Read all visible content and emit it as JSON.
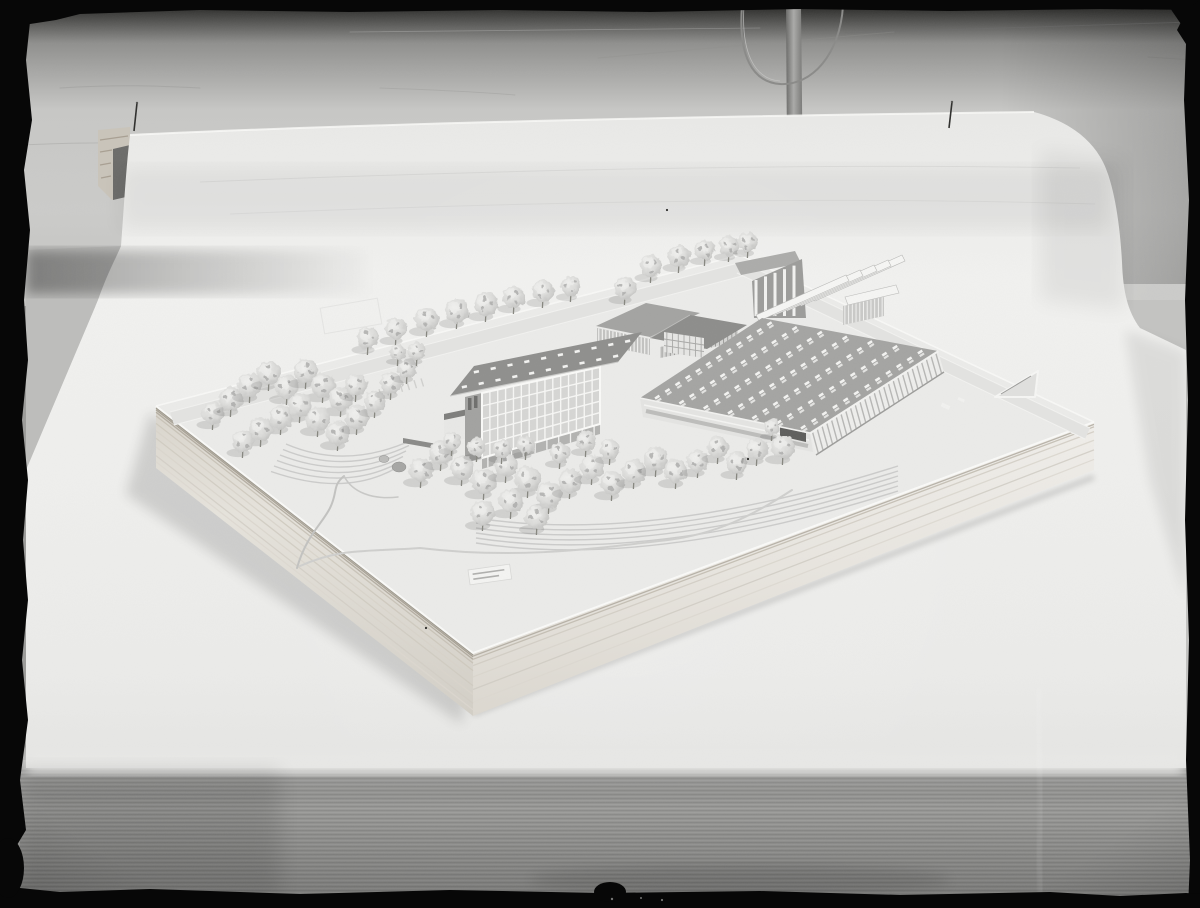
{
  "photo": {
    "kind": "black-and-white photograph",
    "subject": "architectural scale model of a school campus on a wooden baseboard, placed on a cloth-covered table in front of white backdrop paper pinned to a wall",
    "colors": {
      "film_border": "#070707",
      "wall": "#c7c7c5",
      "paper": "#efefed",
      "cloth": "#959593",
      "wood_light": "#e9e6e0",
      "wood_dark": "#9a9487",
      "roof_dark": "#8f8f8d",
      "roof_mid": "#a6a6a4",
      "foliage": "#d7d7d5",
      "skylight": "#f3f3f1",
      "shadow": "#4a4a48"
    },
    "pins": [
      {
        "x1": 137,
        "y1": 103,
        "x2": 134,
        "y2": 131
      },
      {
        "x1": 952,
        "y1": 102,
        "x2": 949,
        "y2": 128
      }
    ],
    "dust_specks": [
      [
        667,
        210
      ],
      [
        748,
        459
      ],
      [
        426,
        628
      ]
    ]
  },
  "model": {
    "base_top": [
      [
        156,
        406
      ],
      [
        740,
        255
      ],
      [
        1094,
        422
      ],
      [
        473,
        653
      ]
    ],
    "base_front_left": [
      [
        156,
        406
      ],
      [
        473,
        653
      ],
      [
        473,
        716
      ],
      [
        156,
        468
      ]
    ],
    "base_front_right": [
      [
        473,
        653
      ],
      [
        1094,
        422
      ],
      [
        1094,
        470
      ],
      [
        473,
        716
      ]
    ],
    "wood_grain_left": {
      "offsets": [
        0.03,
        0.06,
        0.1,
        0.16,
        0.28,
        0.4,
        0.52,
        0.66,
        0.8,
        0.9
      ],
      "colors": [
        "#8e897d",
        "#9b9487",
        "#aaa396",
        "#c4beb2",
        "#cdc7bb",
        "#d8d3c9",
        "#cfcabf",
        "#dad5cc",
        "#d2cdc4",
        "#ddd8d0"
      ]
    },
    "wood_grain_right": {
      "offsets": [
        0.05,
        0.1,
        0.2,
        0.38,
        0.58,
        0.78
      ],
      "colors": [
        "#aca69a",
        "#bdb7ab",
        "#d0cbc1",
        "#d9d5cc",
        "#cfcbc2",
        "#dcd8d0"
      ]
    },
    "plaque": {
      "x": 468,
      "y": 570,
      "w": 42,
      "h": 15,
      "rotation": -8,
      "text_lines": 2
    },
    "roads": {
      "back_left": [
        [
          170,
          412
        ],
        [
          742,
          262
        ],
        [
          746,
          275
        ],
        [
          174,
          425
        ]
      ],
      "back_right": [
        [
          742,
          262
        ],
        [
          1090,
          428
        ],
        [
          1085,
          439
        ],
        [
          737,
          273
        ]
      ]
    },
    "parking": {
      "start": [
        372,
        391
      ],
      "step": [
        7,
        -1.8
      ],
      "count": 8,
      "dash": [
        2.5,
        8
      ]
    },
    "terraces": [
      {
        "start": [
          286,
          444
        ],
        "ctrl": [
          346,
          470
        ],
        "end": [
          412,
          440
        ],
        "count": 6,
        "dx": -3,
        "dy": 5.5
      },
      {
        "start": [
          476,
          518
        ],
        "ctrl": [
          650,
          545
        ],
        "end": [
          898,
          466
        ],
        "count": 6,
        "dx": 0,
        "dy": 5
      }
    ],
    "ponds": [
      {
        "cx": 384,
        "cy": 459,
        "rx": 5,
        "ry": 3.5
      },
      {
        "cx": 399,
        "cy": 467,
        "rx": 7,
        "ry": 5
      }
    ],
    "vehicle": {
      "x": 438,
      "y": 445,
      "w": 10,
      "h": 6,
      "rotation": -12
    },
    "hedge": [
      [
        403,
        438
      ],
      [
        437,
        444
      ],
      [
        437,
        449
      ],
      [
        403,
        443
      ]
    ],
    "buildings": {
      "slab": {
        "name": "four-storey classroom slab with grid curtain wall",
        "roof": [
          [
            450,
            396
          ],
          [
            618,
            362
          ],
          [
            642,
            332
          ],
          [
            474,
            366
          ]
        ],
        "skylight_rows": 2,
        "skylight_cols": 10,
        "facade": [
          [
            482,
            393
          ],
          [
            600,
            367
          ],
          [
            600,
            424
          ],
          [
            482,
            458
          ]
        ],
        "grid_cols": 15,
        "grid_rows": 5,
        "end_wall": [
          [
            465,
            397
          ],
          [
            482,
            393
          ],
          [
            482,
            458
          ],
          [
            465,
            463
          ]
        ],
        "ground_floor": [
          [
            482,
            458
          ],
          [
            600,
            424
          ],
          [
            600,
            434
          ],
          [
            482,
            469
          ]
        ],
        "wing_roof": [
          [
            444,
            414
          ],
          [
            468,
            409
          ],
          [
            468,
            415
          ],
          [
            444,
            420
          ]
        ],
        "wing_wall": [
          [
            444,
            420
          ],
          [
            468,
            415
          ],
          [
            468,
            438
          ],
          [
            444,
            443
          ]
        ]
      },
      "hall": {
        "name": "large workshop hall with skylight-grid roof",
        "roof": [
          [
            640,
            398
          ],
          [
            762,
            318
          ],
          [
            938,
            351
          ],
          [
            810,
            433
          ]
        ],
        "skylight_rows": 7,
        "skylight_cols": 12,
        "front_wall": [
          [
            810,
            433
          ],
          [
            938,
            351
          ],
          [
            944,
            372
          ],
          [
            816,
            455
          ]
        ],
        "front_mullions": 26,
        "left_wing": [
          [
            640,
            398
          ],
          [
            810,
            433
          ],
          [
            813,
            452
          ],
          [
            643,
            417
          ]
        ],
        "entry_canopy": [
          [
            780,
            427
          ],
          [
            806,
            433
          ],
          [
            806,
            442
          ],
          [
            780,
            436
          ]
        ]
      },
      "gym": {
        "name": "glazed gymnasium",
        "roof": [
          [
            596,
            326
          ],
          [
            646,
            303
          ],
          [
            700,
            313
          ],
          [
            650,
            337
          ]
        ],
        "glazing": [
          [
            597,
            328
          ],
          [
            650,
            339
          ],
          [
            650,
            355
          ],
          [
            597,
            344
          ]
        ],
        "mullions": 14
      },
      "pavilion": {
        "name": "hipped-roof pavilion",
        "roof": [
          [
            650,
            338
          ],
          [
            690,
            315
          ],
          [
            747,
            325
          ],
          [
            707,
            349
          ]
        ],
        "glazing": [
          [
            660,
            347
          ],
          [
            738,
            331
          ],
          [
            738,
            342
          ],
          [
            660,
            358
          ]
        ],
        "mullions": 18
      },
      "link": {
        "name": "link block with window grid",
        "body": [
          [
            664,
            332
          ],
          [
            704,
            338
          ],
          [
            704,
            358
          ],
          [
            664,
            352
          ]
        ],
        "mullions": 6
      },
      "sawtooth": {
        "name": "sawtooth-roof workshop",
        "back_block": [
          [
            752,
            281
          ],
          [
            802,
            259
          ],
          [
            806,
            318
          ],
          [
            754,
            318
          ]
        ],
        "pillars": 5,
        "origin": [
          756,
          315
        ],
        "count": 5,
        "dir": [
          90,
          -40
        ],
        "step": [
          14,
          -5
        ],
        "thickness": [
          3,
          6
        ]
      },
      "canopy": {
        "name": "flat canopy on thin columns",
        "slab": [
          [
            845,
            297
          ],
          [
            896,
            285
          ],
          [
            899,
            293
          ],
          [
            848,
            305
          ]
        ],
        "glazing": [
          [
            843,
            306
          ],
          [
            884,
            297
          ],
          [
            884,
            316
          ],
          [
            843,
            325
          ]
        ],
        "mullions": 10
      },
      "flat_roof": [
        [
          735,
          263
        ],
        [
          795,
          251
        ],
        [
          801,
          263
        ],
        [
          741,
          275
        ]
      ],
      "ramp_triangle": [
        [
          995,
          397
        ],
        [
          1038,
          371
        ],
        [
          1035,
          397
        ]
      ],
      "field_marks": [
        {
          "x": 941,
          "y": 404,
          "w": 9,
          "h": 4
        },
        {
          "x": 958,
          "y": 398,
          "w": 7,
          "h": 3
        }
      ]
    },
    "trees": [
      [
        368,
        338,
        11
      ],
      [
        396,
        329,
        11
      ],
      [
        427,
        319,
        12
      ],
      [
        457,
        311,
        12
      ],
      [
        486,
        304,
        12
      ],
      [
        514,
        297,
        11
      ],
      [
        543,
        291,
        11
      ],
      [
        571,
        286,
        10
      ],
      [
        625,
        288,
        11
      ],
      [
        651,
        266,
        11
      ],
      [
        679,
        256,
        11
      ],
      [
        705,
        250,
        10
      ],
      [
        729,
        246,
        10
      ],
      [
        748,
        242,
        10
      ],
      [
        213,
        413,
        11
      ],
      [
        231,
        399,
        12
      ],
      [
        250,
        385,
        12
      ],
      [
        269,
        373,
        12
      ],
      [
        287,
        387,
        12
      ],
      [
        306,
        371,
        12
      ],
      [
        323,
        385,
        12
      ],
      [
        341,
        399,
        12
      ],
      [
        300,
        405,
        12
      ],
      [
        281,
        417,
        12
      ],
      [
        261,
        429,
        12
      ],
      [
        243,
        441,
        11
      ],
      [
        318,
        419,
        12
      ],
      [
        338,
        433,
        12
      ],
      [
        357,
        417,
        12
      ],
      [
        375,
        401,
        11
      ],
      [
        356,
        385,
        11
      ],
      [
        391,
        383,
        11
      ],
      [
        407,
        368,
        10
      ],
      [
        417,
        351,
        9
      ],
      [
        398,
        352,
        8
      ],
      [
        421,
        470,
        12
      ],
      [
        441,
        453,
        12
      ],
      [
        462,
        468,
        12
      ],
      [
        484,
        481,
        13
      ],
      [
        506,
        465,
        12
      ],
      [
        528,
        479,
        13
      ],
      [
        549,
        495,
        13
      ],
      [
        570,
        481,
        12
      ],
      [
        592,
        467,
        12
      ],
      [
        612,
        483,
        12
      ],
      [
        634,
        471,
        12
      ],
      [
        656,
        459,
        12
      ],
      [
        676,
        471,
        12
      ],
      [
        698,
        461,
        11
      ],
      [
        718,
        447,
        11
      ],
      [
        737,
        463,
        11
      ],
      [
        757,
        449,
        11
      ],
      [
        610,
        449,
        10
      ],
      [
        586,
        441,
        10
      ],
      [
        560,
        453,
        10
      ],
      [
        511,
        501,
        12
      ],
      [
        483,
        513,
        12
      ],
      [
        537,
        517,
        12
      ],
      [
        452,
        441,
        9
      ],
      [
        477,
        447,
        9
      ],
      [
        502,
        449,
        9
      ],
      [
        526,
        445,
        9
      ],
      [
        783,
        447,
        12
      ],
      [
        772,
        427,
        8
      ]
    ]
  }
}
